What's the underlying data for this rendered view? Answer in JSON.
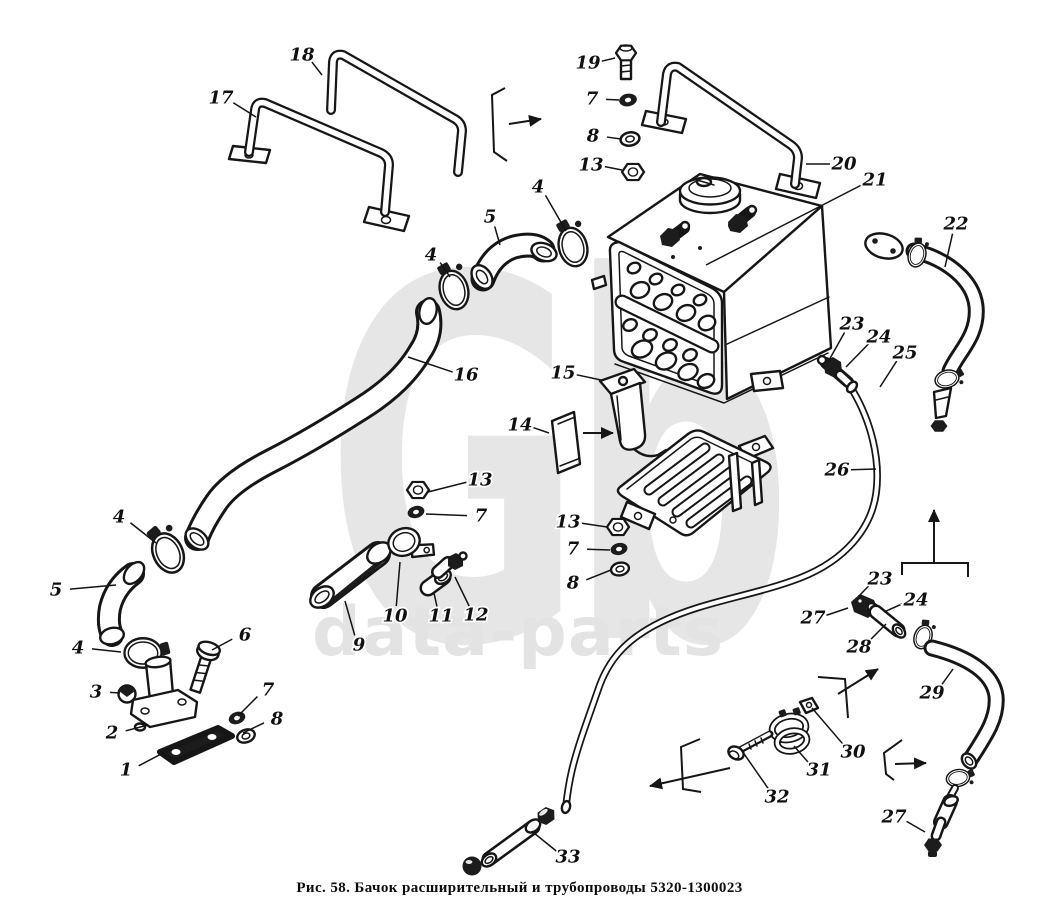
{
  "caption": "Рис. 58. Бачок расширительный и трубопроводы 5320-1300023",
  "watermark": {
    "logo": "Gb",
    "text": "data-parts"
  },
  "callouts": [
    {
      "label": "17",
      "x": 221,
      "y": 98,
      "tx": 256,
      "ty": 117
    },
    {
      "label": "18",
      "x": 302,
      "y": 55,
      "tx": 322,
      "ty": 75
    },
    {
      "label": "19",
      "x": 588,
      "y": 63,
      "tx": 615,
      "ty": 58
    },
    {
      "label": "7",
      "x": 592,
      "y": 99,
      "tx": 619,
      "ty": 100
    },
    {
      "label": "8",
      "x": 593,
      "y": 136,
      "tx": 621,
      "ty": 139
    },
    {
      "label": "13",
      "x": 591,
      "y": 165,
      "tx": 622,
      "ty": 170
    },
    {
      "label": "20",
      "x": 844,
      "y": 164,
      "tx": 806,
      "ty": 164
    },
    {
      "label": "21",
      "x": 875,
      "y": 180,
      "tx": 706,
      "ty": 265
    },
    {
      "label": "22",
      "x": 956,
      "y": 224,
      "tx": 945,
      "ty": 267
    },
    {
      "label": "4",
      "x": 538,
      "y": 187,
      "tx": 566,
      "ty": 231
    },
    {
      "label": "5",
      "x": 490,
      "y": 217,
      "tx": 500,
      "ty": 245
    },
    {
      "label": "4",
      "x": 431,
      "y": 255,
      "tx": 450,
      "ty": 277
    },
    {
      "label": "16",
      "x": 466,
      "y": 375,
      "tx": 408,
      "ty": 357
    },
    {
      "label": "15",
      "x": 563,
      "y": 373,
      "tx": 601,
      "ty": 380
    },
    {
      "label": "14",
      "x": 520,
      "y": 425,
      "tx": 549,
      "ty": 433
    },
    {
      "label": "13",
      "x": 480,
      "y": 480,
      "tx": 428,
      "ty": 492
    },
    {
      "label": "7",
      "x": 481,
      "y": 516,
      "tx": 426,
      "ty": 514
    },
    {
      "label": "13",
      "x": 568,
      "y": 522,
      "tx": 607,
      "ty": 527
    },
    {
      "label": "7",
      "x": 573,
      "y": 549,
      "tx": 610,
      "ty": 550
    },
    {
      "label": "8",
      "x": 573,
      "y": 583,
      "tx": 611,
      "ty": 570
    },
    {
      "label": "9",
      "x": 359,
      "y": 645,
      "tx": 345,
      "ty": 601
    },
    {
      "label": "10",
      "x": 395,
      "y": 616,
      "tx": 400,
      "ty": 562
    },
    {
      "label": "11",
      "x": 441,
      "y": 616,
      "tx": 434,
      "ty": 593
    },
    {
      "label": "12",
      "x": 476,
      "y": 615,
      "tx": 455,
      "ty": 577
    },
    {
      "label": "4",
      "x": 119,
      "y": 517,
      "tx": 156,
      "ty": 543
    },
    {
      "label": "5",
      "x": 56,
      "y": 590,
      "tx": 116,
      "ty": 585
    },
    {
      "label": "4",
      "x": 78,
      "y": 648,
      "tx": 121,
      "ty": 652
    },
    {
      "label": "3",
      "x": 96,
      "y": 692,
      "tx": 120,
      "ty": 693
    },
    {
      "label": "7",
      "x": 268,
      "y": 690,
      "tx": 238,
      "ty": 716
    },
    {
      "label": "2",
      "x": 112,
      "y": 733,
      "tx": 148,
      "ty": 725
    },
    {
      "label": "8",
      "x": 277,
      "y": 719,
      "tx": 243,
      "ty": 733
    },
    {
      "label": "1",
      "x": 126,
      "y": 770,
      "tx": 163,
      "ty": 753
    },
    {
      "label": "6",
      "x": 245,
      "y": 635,
      "tx": 212,
      "ty": 650
    },
    {
      "label": "23",
      "x": 852,
      "y": 324,
      "tx": 828,
      "ty": 362
    },
    {
      "label": "24",
      "x": 879,
      "y": 337,
      "tx": 846,
      "ty": 367
    },
    {
      "label": "25",
      "x": 905,
      "y": 353,
      "tx": 880,
      "ty": 387
    },
    {
      "label": "26",
      "x": 837,
      "y": 470,
      "tx": 876,
      "ty": 469
    },
    {
      "label": "23",
      "x": 880,
      "y": 579,
      "tx": 858,
      "ty": 597
    },
    {
      "label": "24",
      "x": 916,
      "y": 600,
      "tx": 884,
      "ty": 612
    },
    {
      "label": "27",
      "x": 813,
      "y": 618,
      "tx": 848,
      "ty": 608
    },
    {
      "label": "28",
      "x": 859,
      "y": 647,
      "tx": 886,
      "ty": 624
    },
    {
      "label": "29",
      "x": 932,
      "y": 693,
      "tx": 953,
      "ty": 669
    },
    {
      "label": "30",
      "x": 853,
      "y": 752,
      "tx": 812,
      "ty": 708
    },
    {
      "label": "31",
      "x": 819,
      "y": 770,
      "tx": 794,
      "ty": 746
    },
    {
      "label": "32",
      "x": 777,
      "y": 797,
      "tx": 740,
      "ty": 748
    },
    {
      "label": "33",
      "x": 568,
      "y": 857,
      "tx": 534,
      "ty": 833
    },
    {
      "label": "27",
      "x": 894,
      "y": 817,
      "tx": 925,
      "ty": 832
    }
  ]
}
